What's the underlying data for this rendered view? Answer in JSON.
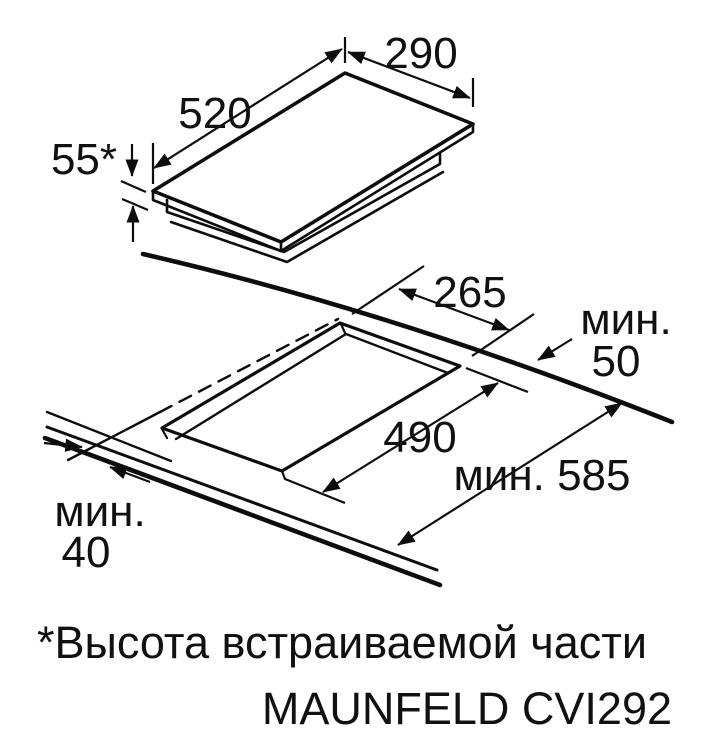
{
  "labels": {
    "hob_width": "290",
    "hob_depth": "520",
    "hob_height": "55*",
    "cutout_width": "265",
    "cutout_depth": "490",
    "rear_min_word": "мин.",
    "rear_min_value": "50",
    "front_min_word": "мин.",
    "front_min_value": "40",
    "worktop_depth_min": "мин. 585",
    "footnote": "*Высота встраиваемой части",
    "model": "MAUNFELD CVI292"
  },
  "colors": {
    "line": "#0d0d0d",
    "background": "#ffffff"
  }
}
